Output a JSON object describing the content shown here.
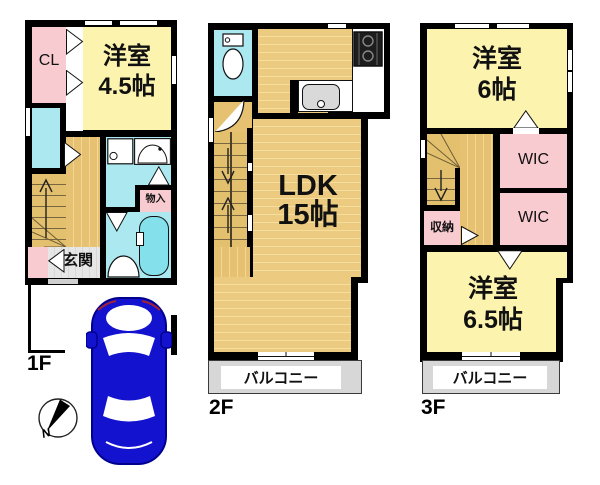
{
  "floors": {
    "f1": {
      "label": "1F",
      "closet": "CL",
      "room": {
        "name": "洋室",
        "size": "4.5帖"
      },
      "entrance": "玄関",
      "storage": "物入"
    },
    "f2": {
      "label": "2F",
      "ldk": {
        "name": "LDK",
        "size": "15帖"
      },
      "balcony": "バルコニー"
    },
    "f3": {
      "label": "3F",
      "room_a": {
        "name": "洋室",
        "size": "6帖"
      },
      "room_b": {
        "name": "洋室",
        "size": "6.5帖"
      },
      "wic_a": "WIC",
      "wic_b": "WIC",
      "storage": "収納",
      "balcony": "バルコニー"
    }
  },
  "compass": {
    "north": "N"
  },
  "colors": {
    "wall": "#000000",
    "room_yellow": "#fbf3ae",
    "closet_pink": "#f8cbd1",
    "wet_area_cyan": "#abe8f0",
    "bathtub_cyan": "#84e0ea",
    "floor_wood_tan": "#eac87b",
    "stair_tan": "#e2c06e",
    "balcony_gray": "#d7d7d7",
    "entrance_gray": "#e3e3e3",
    "car_blue": "#1313cf"
  }
}
